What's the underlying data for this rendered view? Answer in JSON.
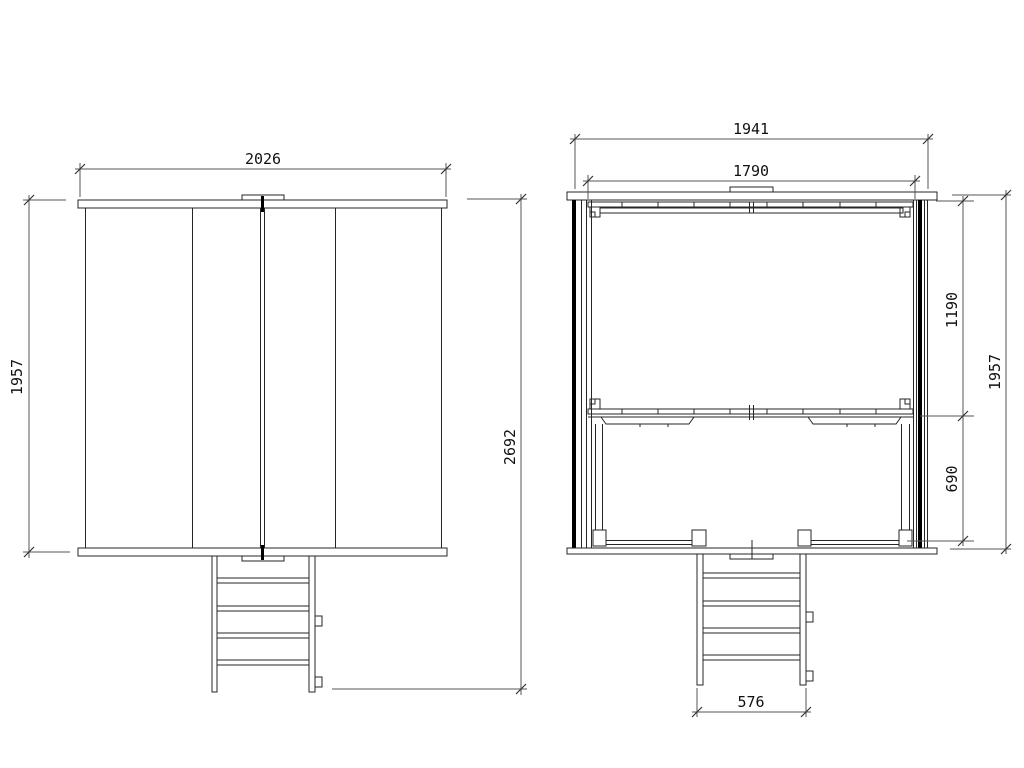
{
  "front_view": {
    "width": "2026",
    "height": "1957",
    "overall_height": "2692"
  },
  "side_view": {
    "roof_width": "1941",
    "frame_width": "1790",
    "upper_section_height": "1190",
    "lower_section_height": "690",
    "height": "1957",
    "ladder_width": "576"
  },
  "colors": {
    "background": "#ffffff",
    "structure_line": "#262626",
    "dimension_line": "#555555",
    "label_text": "#111111"
  }
}
